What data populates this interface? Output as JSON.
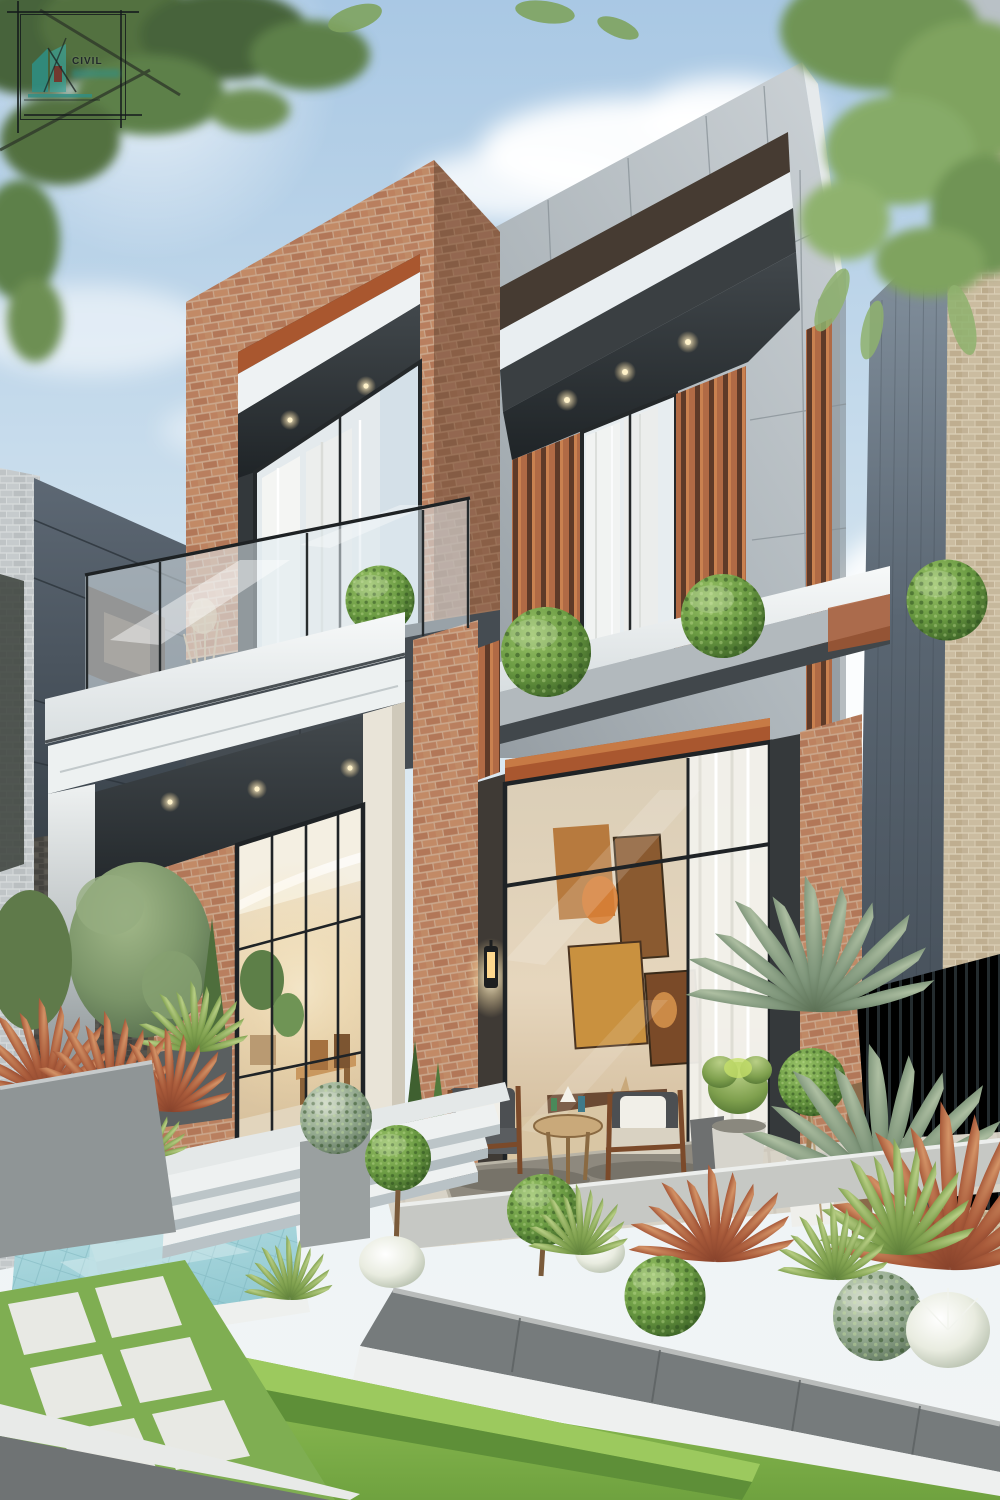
{
  "meta": {
    "width": 1000,
    "height": 1500,
    "scene": "Photorealistic architectural render of a modern two-storey villa with grey panel and terracotta brick facade, glass balcony, warm-lit interiors, landscaped front garden with plunge pool, steps, patio seating and sculpted plants under a blue sky with overhanging tree branches"
  },
  "watermark": {
    "text": "CIVIL",
    "icon": "house-drafting-logo-icon",
    "frame": "square-drafting-border",
    "accent_color": "#2e8f86",
    "ink_color": "#1d2524"
  },
  "palette": {
    "sky_top": "#a9c8e4",
    "sky_mid": "#cfe1ee",
    "sky_low": "#edf3f6",
    "cloud_white": "#ffffff",
    "foliage_dark": "#46633a",
    "foliage_mid": "#5d8048",
    "foliage_light": "#7fa35f",
    "facade_light": "#ccd2d6",
    "facade_mid": "#aeb6bb",
    "facade_shadow": "#8f979d",
    "band_dark": "#3a3430",
    "soffit_dark": "#24282b",
    "brick_base": "#bb8263",
    "brick_light": "#cf9a77",
    "brick_shadow": "#96624a",
    "wood_accent": "#a9572f",
    "wood_light": "#c97f4e",
    "glass_tint": "#e3ebef",
    "curtain_white": "#f2f3f0",
    "white_trim": "#f4f7f7",
    "interior_warm": "#e8d8bd",
    "interior_glow": "#ffcf8e",
    "art_orange": "#c97a3a",
    "topiary_green": "#5f9140",
    "topiary_light": "#9cc56a",
    "lawn_green": "#6fa23f",
    "lawn_bright": "#8cba52",
    "hedge_green": "#7fb24a",
    "pool_water": "#b5dde2",
    "pool_deep": "#8cc6cf",
    "planter_gray": "#9aa0a2",
    "wall_dark": "#6f7478",
    "curb_white": "#eef0ef",
    "fence_dark": "#343d40",
    "neighbor_gray_brick": "#c9cdce",
    "neighbor_beige_brick": "#ccbfa6",
    "neighbor_panel": "#4e5a66",
    "cordyline_red": "#a1543a",
    "cordyline_light": "#c9845a",
    "fluffy_white": "#e9ece4",
    "shrub_sage": "#8aa78f",
    "furniture_wood": "#7b4a2a",
    "cushion_white": "#f1efe8",
    "paver_light": "#e8e9e4",
    "lantern_glow": "#f7c97e",
    "street_gray": "#6f7374",
    "watermark_teal": "#2e8f86"
  },
  "scene_elements": [
    "sky",
    "clouds",
    "overhanging-tree-canopy-left",
    "overhanging-tree-canopy-right",
    "neighbor-house-left",
    "neighbor-house-right",
    "main-house-grey-panel-facade",
    "parapet-accent-band",
    "brick-feature-frame",
    "upper-window-wood-slats",
    "upper-window-sheer-curtains",
    "balcony-glass-railing",
    "balcony-topiary-ball",
    "entrance-porch-white-frame",
    "recessed-downlights",
    "entrance-glazing-dining-interior",
    "living-room-window-art-wall",
    "wall-lantern",
    "patio-armchairs",
    "patio-side-table",
    "potted-plants",
    "yucca-palms",
    "front-garden-planters",
    "ornamental-grasses",
    "topiary-balls",
    "plunge-pool",
    "garden-steps",
    "box-hedge",
    "lawn",
    "paved-walkway",
    "street-curb",
    "civil-logo-watermark"
  ]
}
